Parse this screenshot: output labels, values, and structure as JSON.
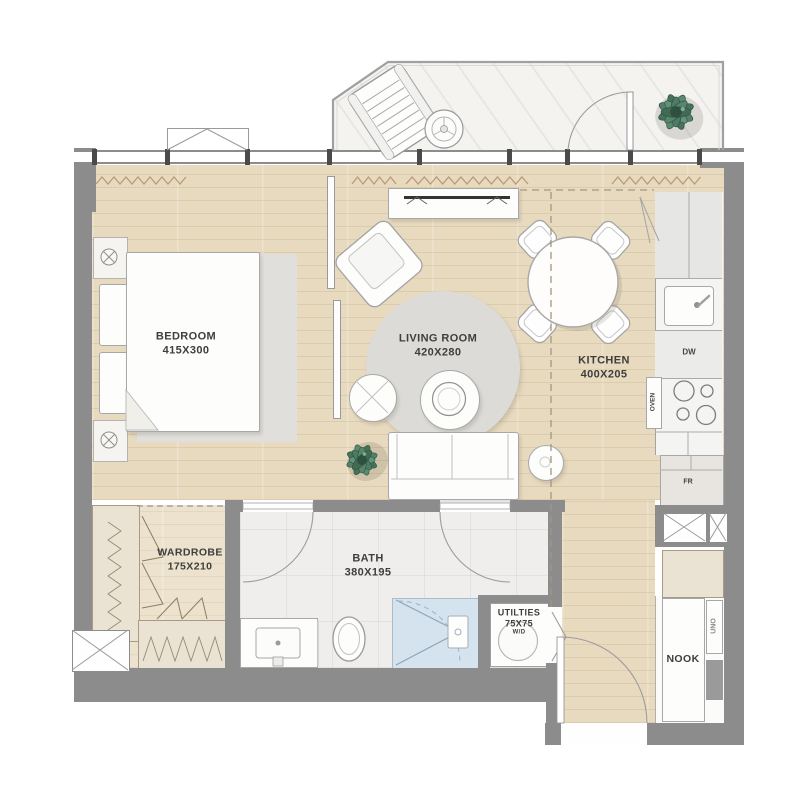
{
  "plan": {
    "type": "apartment-floor-plan",
    "rooms": [
      {
        "id": "bedroom",
        "name": "BEDROOM",
        "dims": "415X300"
      },
      {
        "id": "living",
        "name": "LIVING ROOM",
        "dims": "420X280"
      },
      {
        "id": "kitchen",
        "name": "KITCHEN",
        "dims": "400X205"
      },
      {
        "id": "wardrobe",
        "name": "WARDROBE",
        "dims": "175X210"
      },
      {
        "id": "bath",
        "name": "BATH",
        "dims": "380X195"
      },
      {
        "id": "utilities",
        "name": "UTILTIES",
        "dims": "75X75",
        "appliance": "W/D"
      },
      {
        "id": "nook",
        "name": "NOOK"
      }
    ],
    "appliance_labels": {
      "dishwasher": "DW",
      "oven": "OVEN",
      "fridge": "FR",
      "nook_unit": "UNO"
    },
    "colors": {
      "wall": "#8c8c8c",
      "wood_floor": "#e8dabf",
      "tile_floor": "#efeeec",
      "balcony_marble": "#f4f3f0",
      "shower": "#d4e3ee",
      "rug": "#dcdbd7",
      "plant": "#4e7b60",
      "label_text": "#3e3e3e"
    }
  }
}
